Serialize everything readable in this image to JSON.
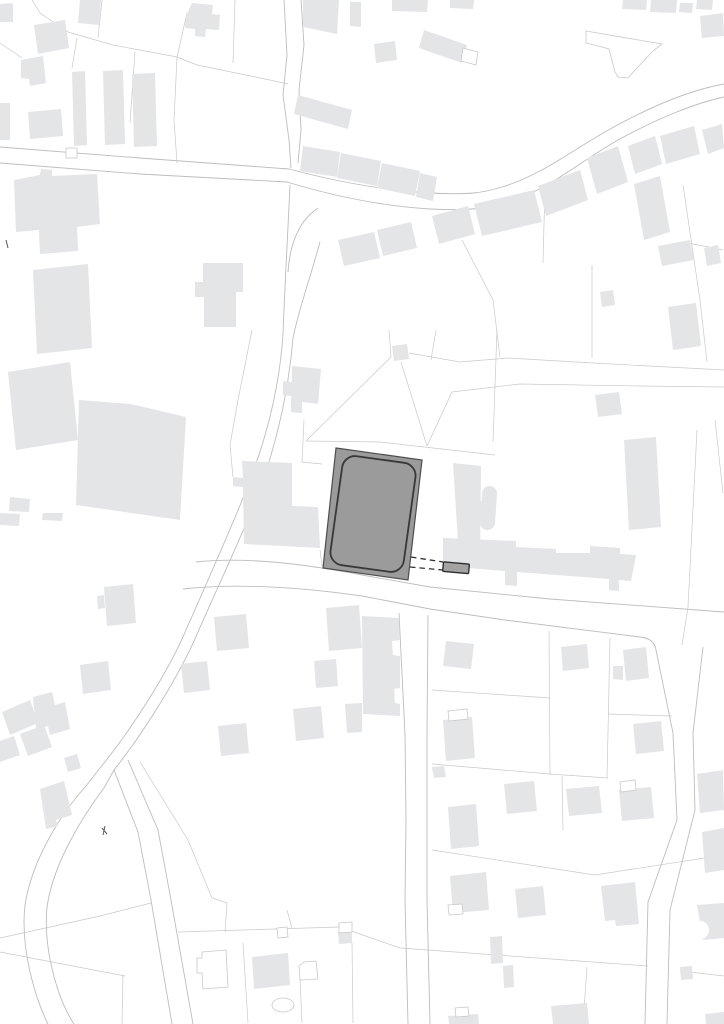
{
  "canvas": {
    "width": 724,
    "height": 1024,
    "background": "#ffffff"
  },
  "palette": {
    "paper": "#ffffff",
    "building_fill": "#e4e5e6",
    "parcel_line": "#c9c9c9",
    "road_line": "#bdbdbd",
    "highlight_fill": "#9b9b9b",
    "highlight_stroke": "#4d4d4d",
    "inner_stroke": "#383838",
    "annex_fill": "#a3a3a3",
    "annex_stroke": "#2f2f2f",
    "dash_stroke": "#2f2f2f",
    "mark_stroke": "#5a5a5a"
  },
  "map": {
    "road_lines": [
      "M0,147 L140,158 L289,169",
      "M0,163 L140,174 L287,182",
      "M284,0 L287,55 L283,95 L289,140 L291,168",
      "M301,0 L304,45 L299,90 L301,130 L298,163",
      "M289,169 C330,180 380,190 430,193 C470,195 482,193 502,187 C542,175 572,150 612,128 C652,106 690,90 724,84",
      "M287,182 C330,195 380,206 430,209 C472,211 488,208 508,202 C548,190 578,163 618,140 C658,118 696,103 724,97",
      "M290,185 C288,230 285,280 283,334 C279,396 262,452 243,498 C226,540 208,580 186,630 C170,668 135,725 100,768 L86,786",
      "M320,242 C309,282 298,312 293,338 C288,398 274,452 256,500 C239,542 220,582 198,632 C182,670 148,727 114,770 L104,788",
      "M288,272 C290,242 300,220 318,208",
      "M86,786 C60,815 32,860 25,905 C20,950 36,1000 48,1024",
      "M104,788 C80,820 53,865 47,907 C43,950 58,1000 74,1024",
      "M114,770 L138,832 L151,900 L172,1024",
      "M128,760 L158,830 L171,900 L193,1024",
      "M196,562 C240,557 300,563 362,575 L430,587 L550,599 L724,612",
      "M183,589 C240,583 300,587 362,596 L430,609 L505,620 L640,637 C650,638 655,643 656,650",
      "M656,650 L673,733 L677,820 L648,902 L645,1024",
      "M703,647 L693,733 L695,810 L680,870 L670,910 L667,1024",
      "M399,613 L405,735 L406,820 L405,900 L408,1024",
      "M428,615 L427,735 L427,820 L427,900 L430,1024"
    ],
    "parcel_lines": [
      "M32,0 L40,13 L68,32 L113,45 L177,57 L197,65 L270,80 L288,84",
      "M102,0 L98,38",
      "M77,38 L72,68",
      "M0,43 L22,58",
      "M187,13 L177,57",
      "M135,52 L130,123",
      "M177,57 L174,120 L177,163",
      "M235,0 L233,63",
      "M306,441 L391,357",
      "M391,357 L389,330",
      "M401,362 L427,446",
      "M409,353 L460,362 L508,358 L593,363 L724,370",
      "M497,330 L493,442",
      "M306,441 L380,442 L495,455",
      "M427,446 L452,392 L520,384 L640,386 L724,387",
      "M436,330 L431,360",
      "M462,240 L493,300 L500,357",
      "M592,265 L592,358",
      "M683,185 L700,300 L707,362",
      "M545,185 L543,263",
      "M683,242 L723,250",
      "M304,420 L302,462 L322,464",
      "M320,550 L322,566",
      "M252,330 L238,400 L230,445 L233,477",
      "M549,631 L550,775",
      "M610,638 L607,778",
      "M608,714 L672,716",
      "M432,690 L550,698",
      "M432,764 L550,774 L608,778",
      "M562,776 L563,830",
      "M697,430 L688,607 L682,645",
      "M715,420 L723,493",
      "M432,850 L595,875 L724,855",
      "M178,932 L340,927 L400,948 L648,966",
      "M680,971 L724,976",
      "M587,967 L583,1024",
      "M227,903 L225,932",
      "M287,910 L292,928",
      "M243,943 L248,1023",
      "M300,980 L302,1023",
      "M352,943 L353,1023",
      "M151,903 L100,916 L0,938",
      "M125,976 L0,952",
      "M123,975 L122,1024",
      "M140,762 L188,840 L212,898 L227,903"
    ],
    "buildings": [
      "M0,4 L13,3 L13,22 L0,22 Z",
      "M80,0 L101,0 L99,25 L78,23 Z",
      "M34,25 L65,20 L69,48 L38,54 Z",
      "M21,60 L43,56 L46,83 L30,86 L29,79 L21,78 Z",
      "M186,16 L192,3 L213,5 L212,14 L220,15 L219,30 L206,29 L205,37 L195,36 L195,29 L185,28 Z",
      "M72,72 L85,71 L87,145 L74,146 Z",
      "M103,71 L123,70 L125,144 L105,145 Z",
      "M132,74 L155,73 L157,146 L134,147 Z",
      "M0,103 L10,103 L10,140 L0,140 Z",
      "M28,112 L61,109 L63,136 L30,139 Z",
      "M303,0 L339,0 L337,34 L303,27 Z",
      "M350,2 L361,2 L361,27 L350,26 Z",
      "M392,0 L428,0 L427,12 L392,11 Z",
      "M450,0 L474,0 L473,9 L450,8 Z",
      "M374,44 L395,41 L397,60 L376,63 Z",
      "M424,30 L467,45 L462,63 L419,48 Z",
      "M298,95 L352,110 L348,129 L294,114 Z",
      "M303,146 L340,152 L337,177 L300,171 Z",
      "M341,153 L381,161 L377,186 L337,178 Z",
      "M382,163 L420,171 L415,196 L377,188 Z",
      "M420,173 L437,177 L433,201 L416,197 Z",
      "M623,0 L647,0 L646,10 L622,9 Z",
      "M651,0 L677,0 L676,13 L650,12 Z",
      "M680,3 L693,3 L692,13 L679,12 Z",
      "M697,0 L713,0 L712,10 L696,9 Z",
      "M700,16 L723,13 L724,36 L702,38 Z",
      "M338,240 L374,232 L380,258 L344,266 Z",
      "M377,230 L411,222 L417,248 L383,256 Z",
      "M432,216 L468,206 L475,234 L439,244 Z",
      "M474,204 L534,190 L542,222 L482,236 Z",
      "M538,186 L580,170 L588,200 L546,216 Z",
      "M587,158 L618,146 L628,182 L597,194 Z",
      "M628,146 L655,136 L662,164 L635,174 Z",
      "M660,136 L694,126 L700,154 L666,164 Z",
      "M702,130 L722,124 L724,148 L708,154 Z",
      "M634,184 L660,176 L670,232 L644,240 Z",
      "M658,246 L690,240 L694,260 L662,266 Z",
      "M704,248 L718,245 L721,263 L707,266 Z",
      "M600,292 L613,290 L615,305 L602,307 Z",
      "M668,307 L696,303 L701,346 L673,350 Z",
      "M595,395 L619,392 L622,414 L598,417 Z",
      "M203,263 L243,263 L243,292 L236,292 L236,327 L204,327 L204,297 L195,297 L195,282 L203,282 Z",
      "M392,346 L407,344 L409,359 L394,361 Z",
      "M14,180 L40,175 L41,169 L52,170 L52,176 L97,174 L100,224 L77,227 L78,251 L40,254 L39,230 L16,232 Z",
      "M33,270 L88,264 L92,348 L37,354 Z",
      "M8,372 L70,362 L78,440 L16,450 Z",
      "M79,400 L131,404 L186,417 L180,520 L76,505 Z",
      "M292,366 L321,369 L318,404 L302,402 L302,413 L291,412 L291,396 L283,395 L283,381 L292,382 Z",
      "M242,461 L292,463 L292,506 L318,507 L320,548 L244,544 L243,487 L233,486 L233,477 L243,478 Z",
      "M453,463 L481,466 L480,559 L459,557 Z",
      "M482,493 A7.5,7.5 0 0 1 497,494 L495,523 A7.5,7.5 0 0 1 480,522 Z",
      "M473,500 L482,501 L481,513 L472,512 Z",
      "M443,538 L516,541 L516,547 L556,549 L556,553 L590,553 L590,546 L620,548 L620,554 L636,555 L631,581 L619,580 L619,591 L609,590 L609,579 L517,572 L517,586 L505,585 L505,571 L443,566 Z",
      "M624,440 L656,437 L661,527 L629,530 Z",
      "M446,641 L474,644 L471,669 L443,666 Z",
      "M561,647 L587,644 L589,668 L563,671 Z",
      "M623,650 L646,647 L649,678 L626,681 Z",
      "M613,666 L623,666 L623,680 L613,679 Z",
      "M633,724 L661,721 L664,751 L636,754 Z",
      "M443,720 L472,717 L475,758 L446,761 Z",
      "M504,784 L534,781 L537,811 L507,814 Z",
      "M566,789 L599,786 L602,813 L569,816 Z",
      "M619,790 L651,787 L654,818 L622,821 Z",
      "M432,767 L444,766 L446,777 L434,778 Z",
      "M448,807 L476,804 L479,846 L451,849 Z",
      "M450,876 L486,872 L489,910 L453,913 Z",
      "M515,889 L543,886 L546,915 L518,918 Z",
      "M601,886 L635,882 L639,924 L616,926 L615,920 L605,921 Z",
      "M703,909 L723,906 L724,930 L706,933 Z",
      "M490,937 L502,936 L503,963 L491,964 Z",
      "M503,966 L513,965 L514,987 L504,988 Z",
      "M551,1006 L587,1003 L589,1024 L553,1024 Z",
      "M448,1016 L478,1014 L479,1024 L449,1024 Z",
      "M697,774 L723,770 L724,810 L700,813 Z",
      "M702,832 L724,828 L724,870 L705,873 Z",
      "M697,905 L724,903 L724,938 L703,940 Z",
      "M680,967 L692,966 L693,979 L681,980 Z",
      "M705,1014 L724,1012 L724,1024 L706,1024 Z",
      "M338,932 L352,931 L352,943 L339,944 Z",
      "M104,587 L133,584 L136,623 L107,626 Z",
      "M97,596 L104,595 L105,608 L98,609 Z",
      "M80,665 L108,661 L111,690 L83,694 Z",
      "M33,697 L52,692 L55,705 L65,702 L70,729 L50,735 L48,726 L36,729 Z",
      "M2,712 L30,700 L38,723 L10,735 Z",
      "M20,734 L44,725 L52,747 L28,756 Z",
      "M0,741 L14,736 L20,755 L0,762 Z",
      "M64,758 L77,754 L81,768 L68,772 Z",
      "M40,789 L64,781 L72,815 L56,820 L58,826 L46,829 Z",
      "M214,617 L246,614 L249,648 L217,651 Z",
      "M181,664 L207,661 L210,690 L184,693 Z",
      "M218,726 L246,723 L249,753 L221,756 Z",
      "M293,709 L321,706 L324,738 L296,741 Z",
      "M326,608 L359,605 L362,648 L329,651 Z",
      "M314,661 L336,659 L338,686 L316,688 Z",
      "M345,704 L362,703 L362,732 L347,733 Z",
      "M362,616 L399,618 L400,640 L392,641 L393,655 L400,656 L400,688 L394,689 L395,703 L400,704 L400,716 L363,714 Z",
      "M252,957 L288,953 L290,985 L254,989 Z",
      "M10,497 L30,499 L29,512 L9,511 Z",
      "M0,513 L20,514 L19,526 L0,525 Z",
      "M43,513 L63,513 L62,521 L42,520 Z"
    ],
    "outline_shapes": [
      {
        "d": "M586,31 L662,44 L653,51 L637,68 L628,78 L618,77 L615,72 L609,49 L602,47 L586,43 Z"
      },
      {
        "d": "M463,48 L478,52 L476,65 L461,61 Z"
      },
      {
        "d": "M448,711 L467,709 L468,719 L449,721 Z"
      },
      {
        "d": "M620,782 L635,780 L636,790 L621,792 Z"
      },
      {
        "d": "M448,905 L462,904 L463,914 L449,915 Z"
      },
      {
        "d": "M202,952 L226,950 L228,987 L203,989 L202,973 L197,973 L197,958 L202,958 Z"
      },
      {
        "d": "M299,966 L304,962 L316,961 L318,979 L300,980 Z"
      },
      {
        "d": "M277,928 L287,927 L288,937 L278,938 Z"
      },
      {
        "d": "M339,923 L352,922 L352,932 L339,933 Z"
      },
      {
        "d": "M66,148 L77,148 L77,158 L66,158 Z"
      },
      {
        "d": "M455,1008 L468,1007 L469,1016 L456,1017 Z"
      },
      {
        "ellipse": [
          283,
          1005,
          11,
          7
        ]
      },
      {
        "ellipse": [
          700,
          930,
          9,
          9
        ],
        "fill": "#ffffff",
        "stroke": "none"
      }
    ],
    "highlight": {
      "building_outline": "M336,448 L422,460 L408,580 L323,568 Z",
      "inner_rect": {
        "x": 336,
        "y": 459,
        "w": 74,
        "h": 110,
        "rx": 13,
        "rotate": "7.9 373 514"
      },
      "annex_rect": {
        "x": 443,
        "y": 563,
        "w": 26,
        "h": 9.5,
        "rx": 1,
        "rotate": "5 456 568"
      },
      "dashed_lines": [
        "M411,557 L443,562",
        "M410,567 L443,570"
      ]
    },
    "marks": [
      "M6,240 L8,248",
      "M102,828 L107,834",
      "M105,826 L103,835"
    ]
  }
}
